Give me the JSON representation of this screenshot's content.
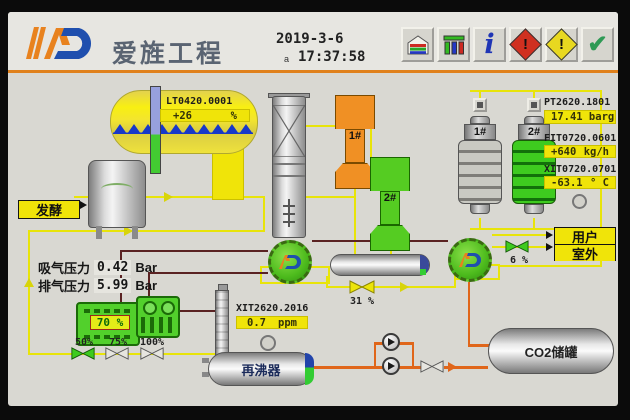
{
  "header": {
    "company": "爱旌工程",
    "date": "2019-3-6",
    "marker": "a",
    "time": "17:37:58"
  },
  "toolbar": {
    "items": [
      {
        "name": "home"
      },
      {
        "name": "trend"
      },
      {
        "name": "info",
        "glyph": "i"
      },
      {
        "name": "alarm-critical",
        "glyph": "!"
      },
      {
        "name": "alarm-warning",
        "glyph": "!"
      },
      {
        "name": "acknowledge",
        "glyph": "✔"
      }
    ]
  },
  "instruments": {
    "level": {
      "tag": "LT0420.0001",
      "value": "+26",
      "unit": "%"
    },
    "pressure": {
      "tag": "PT2620.1801",
      "value": "17.41 barg"
    },
    "flow": {
      "tag": "FIT0720.0601",
      "value": "+640",
      "unit": "kg/h"
    },
    "temperature": {
      "tag": "XIT0720.0701",
      "value": "-63.1",
      "unit": "° C"
    },
    "purity": {
      "tag": "XIT2620.2016",
      "value": "0.7",
      "unit": "ppm"
    }
  },
  "compressor": {
    "suction": {
      "label": "吸气压力",
      "value": "0.42",
      "unit": "Bar"
    },
    "discharge": {
      "label": "排气压力",
      "value": "5.99",
      "unit": "Bar"
    },
    "load": "70 %",
    "steps": [
      {
        "label": "50%"
      },
      {
        "label": "75%"
      },
      {
        "label": "100%"
      }
    ]
  },
  "valves": {
    "recycle": "31 %",
    "supply": "6 %"
  },
  "buttons": {
    "fermenter": "发酵",
    "user": "用户",
    "outdoor": "室外"
  },
  "vessels": {
    "reboiler": "再沸器",
    "co2_tank": "CO2储罐",
    "filter_1": "1#",
    "filter_2": "2#",
    "dryer_1": "1#",
    "dryer_2": "2#"
  },
  "colors": {
    "pipe_yellow": "#e8e40a",
    "pipe_orange": "#e0661a",
    "pipe_maroon": "#5a2222",
    "panel": "#d9d8d2",
    "accent_orange": "#e0811c",
    "hmi_yellow": "#f0e409",
    "hmi_green": "#3ecb1f"
  }
}
